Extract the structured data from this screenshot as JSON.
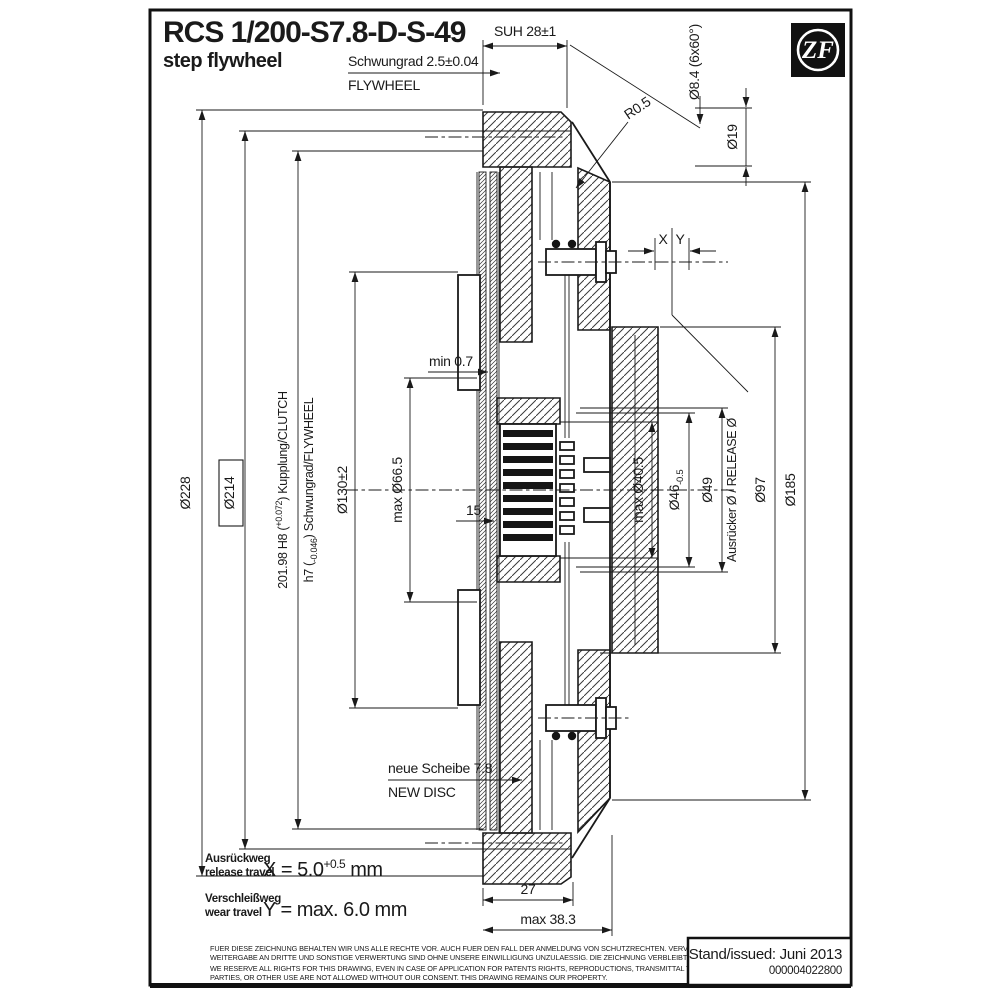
{
  "colors": {
    "ink": "#1a1a1a",
    "paper": "#ffffff"
  },
  "header": {
    "model": "RCS 1/200-S7.8-D-S-49",
    "type_label": "step flywheel",
    "logo": "ZF"
  },
  "dims": {
    "suh": "SUH 28±1",
    "flywheel_step_de": "Schwungrad 2.5±0.04",
    "flywheel_step_en": "FLYWHEEL",
    "bolt_circle": "Ø8.4 (6x60°)",
    "d19": "Ø19",
    "r05": "R0.5",
    "x": "X",
    "y": "Y",
    "d228": "Ø228",
    "d214": "Ø214",
    "fit1_pre": "201.98 H8 (",
    "fit1_tol": "+0.072",
    "fit1_post": ") Kupplung/CLUTCH",
    "fit2_pre": "h7 (",
    "fit2_tol": "-0.046",
    "fit2_post": ") Schwungrad/FLYWHEEL",
    "d130": "Ø130±2",
    "d665": "max Ø66.5",
    "min07": "min 0.7",
    "d15": "15",
    "d405": "max Ø40.5",
    "d46_pre": "Ø46",
    "d46_tol": "-0.5",
    "d49": "Ø49",
    "release": "Ausrücker Ø / RELEASE Ø",
    "d97": "Ø97",
    "d185": "Ø185",
    "new_disc_de": "neue Scheibe 7.8",
    "new_disc_en": "NEW DISC",
    "w27": "27",
    "w383": "max 38.3"
  },
  "travel": {
    "release_de": "Ausrückweg",
    "release_en": "release travel",
    "x_pre": "X = 5.0",
    "x_tol": "+0.5",
    "x_unit": " mm",
    "wear_de": "Verschleißweg",
    "wear_en": "wear travel",
    "y_eq": "Y = max. 6.0 mm"
  },
  "footer": {
    "disclaimer_de_1": "FUER DIESE ZEICHNUNG BEHALTEN WIR UNS ALLE RECHTE VOR. AUCH FUER DEN FALL DER ANMELDUNG VON SCHUTZRECHTEN. VERVIELFAELTIGUNG,",
    "disclaimer_de_2": "WEITERGABE AN DRITTE UND SONSTIGE VERWERTUNG SIND OHNE UNSERE EINWILLIGUNG UNZULAESSIG. DIE ZEICHNUNG VERBLEIBT UNSER EIGENTUM.",
    "disclaimer_en_1": "WE RESERVE ALL RIGHTS FOR THIS DRAWING, EVEN IN CASE OF APPLICATION FOR PATENTS RIGHTS, REPRODUCTIONS, TRANSMITTAL TO THIRD",
    "disclaimer_en_2": "PARTIES, OR OTHER USE ARE NOT ALLOWED WITHOUT OUR CONSENT. THIS DRAWING REMAINS OUR PROPERTY.",
    "issued": "Stand/issued: Juni 2013",
    "doc_number": "000004022800"
  }
}
